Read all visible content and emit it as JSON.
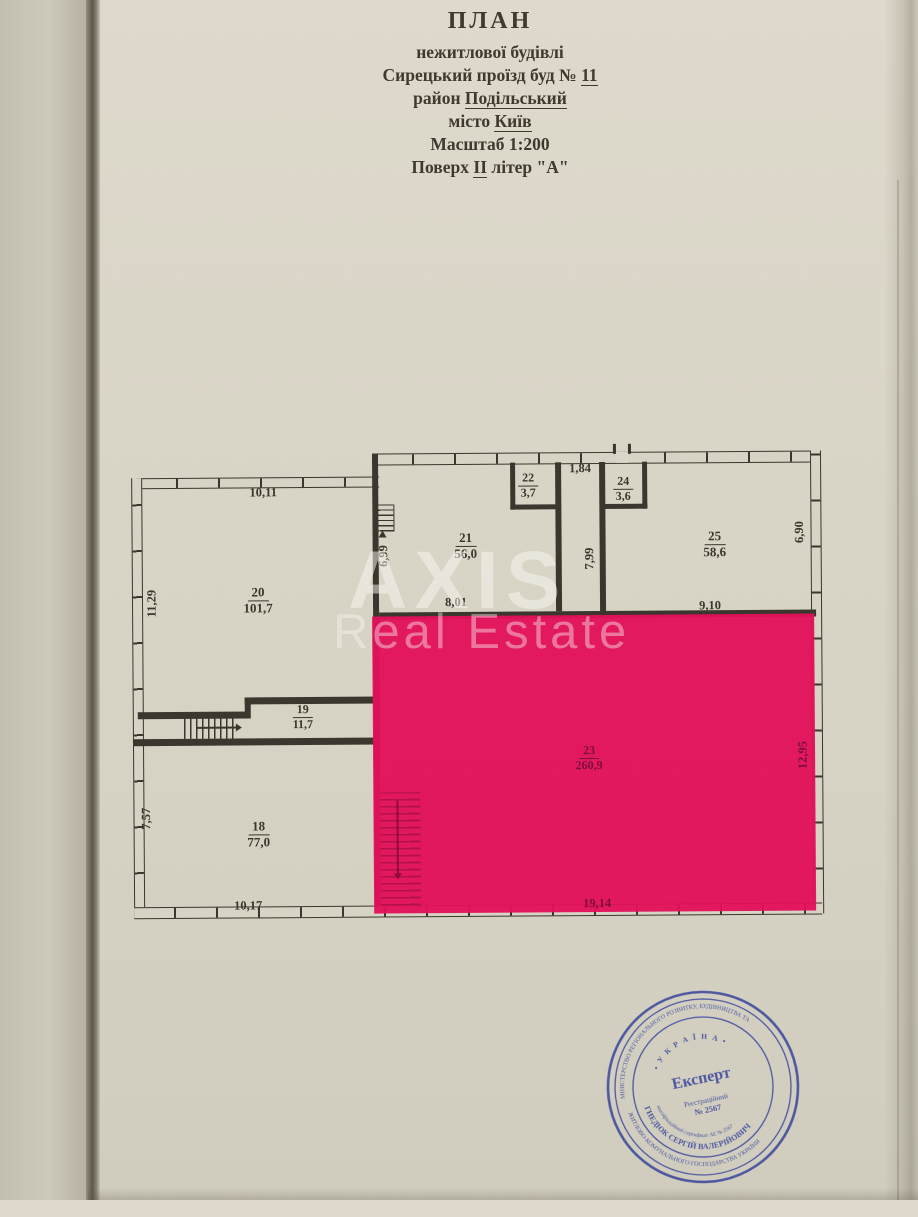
{
  "header": {
    "title": "ПЛАН",
    "line2": "нежитлової будівлі",
    "line3_prefix": "Сирецький проїзд буд № ",
    "line3_underlined": "11",
    "line4_prefix": "район ",
    "line4_underlined": "Подільський",
    "line5_prefix": "місто ",
    "line5_underlined": "Київ",
    "line6": "Масштаб 1:200",
    "line7_prefix": "Поверх ",
    "line7_underlined": "ІІ",
    "line7_suffix": " літер \"А\""
  },
  "watermark": {
    "line1": "AXIS",
    "line2": "Real Estate"
  },
  "plan": {
    "highlight_color": "#e2115b",
    "rooms": [
      {
        "number": "20",
        "area": "101,7"
      },
      {
        "number": "21",
        "area": "56,0"
      },
      {
        "number": "22",
        "area": "3,7"
      },
      {
        "number": "24",
        "area": "3,6"
      },
      {
        "number": "25",
        "area": "58,6"
      },
      {
        "number": "19",
        "area": "11,7"
      },
      {
        "number": "18",
        "area": "77,0"
      },
      {
        "number": "23",
        "area": "260,9"
      }
    ],
    "dimensions": [
      {
        "value": "10,11"
      },
      {
        "value": "11,29"
      },
      {
        "value": "6,99"
      },
      {
        "value": "8,01"
      },
      {
        "value": "1,84"
      },
      {
        "value": "7,99"
      },
      {
        "value": "9,10"
      },
      {
        "value": "6,90"
      },
      {
        "value": "19,14"
      },
      {
        "value": "12,95"
      },
      {
        "value": "7,57"
      },
      {
        "value": "10,17"
      }
    ]
  },
  "stamp": {
    "color": "#35429b",
    "outer_ring_top": "МІНІСТЕРСТВО РЕГІОНАЛЬНОГО РОЗВИТКУ, БУДІВНИЦТВА ТА",
    "outer_ring_bottom": "ЖИТЛОВО-КОМУНАЛЬНОГО ГОСПОДАРСТВА УКРАЇНИ",
    "country": "• У К Р А Ї Н А •",
    "center_title": "Експерт",
    "reg_line1": "Реєстраційний",
    "reg_line2": "№ 2567",
    "name_ring": "ГНЕДЮК СЕРГІЙ ВАЛЕРІЙОВИЧ",
    "cert_ring": "кваліфікаційний сертифікат АЕ № 2567"
  }
}
